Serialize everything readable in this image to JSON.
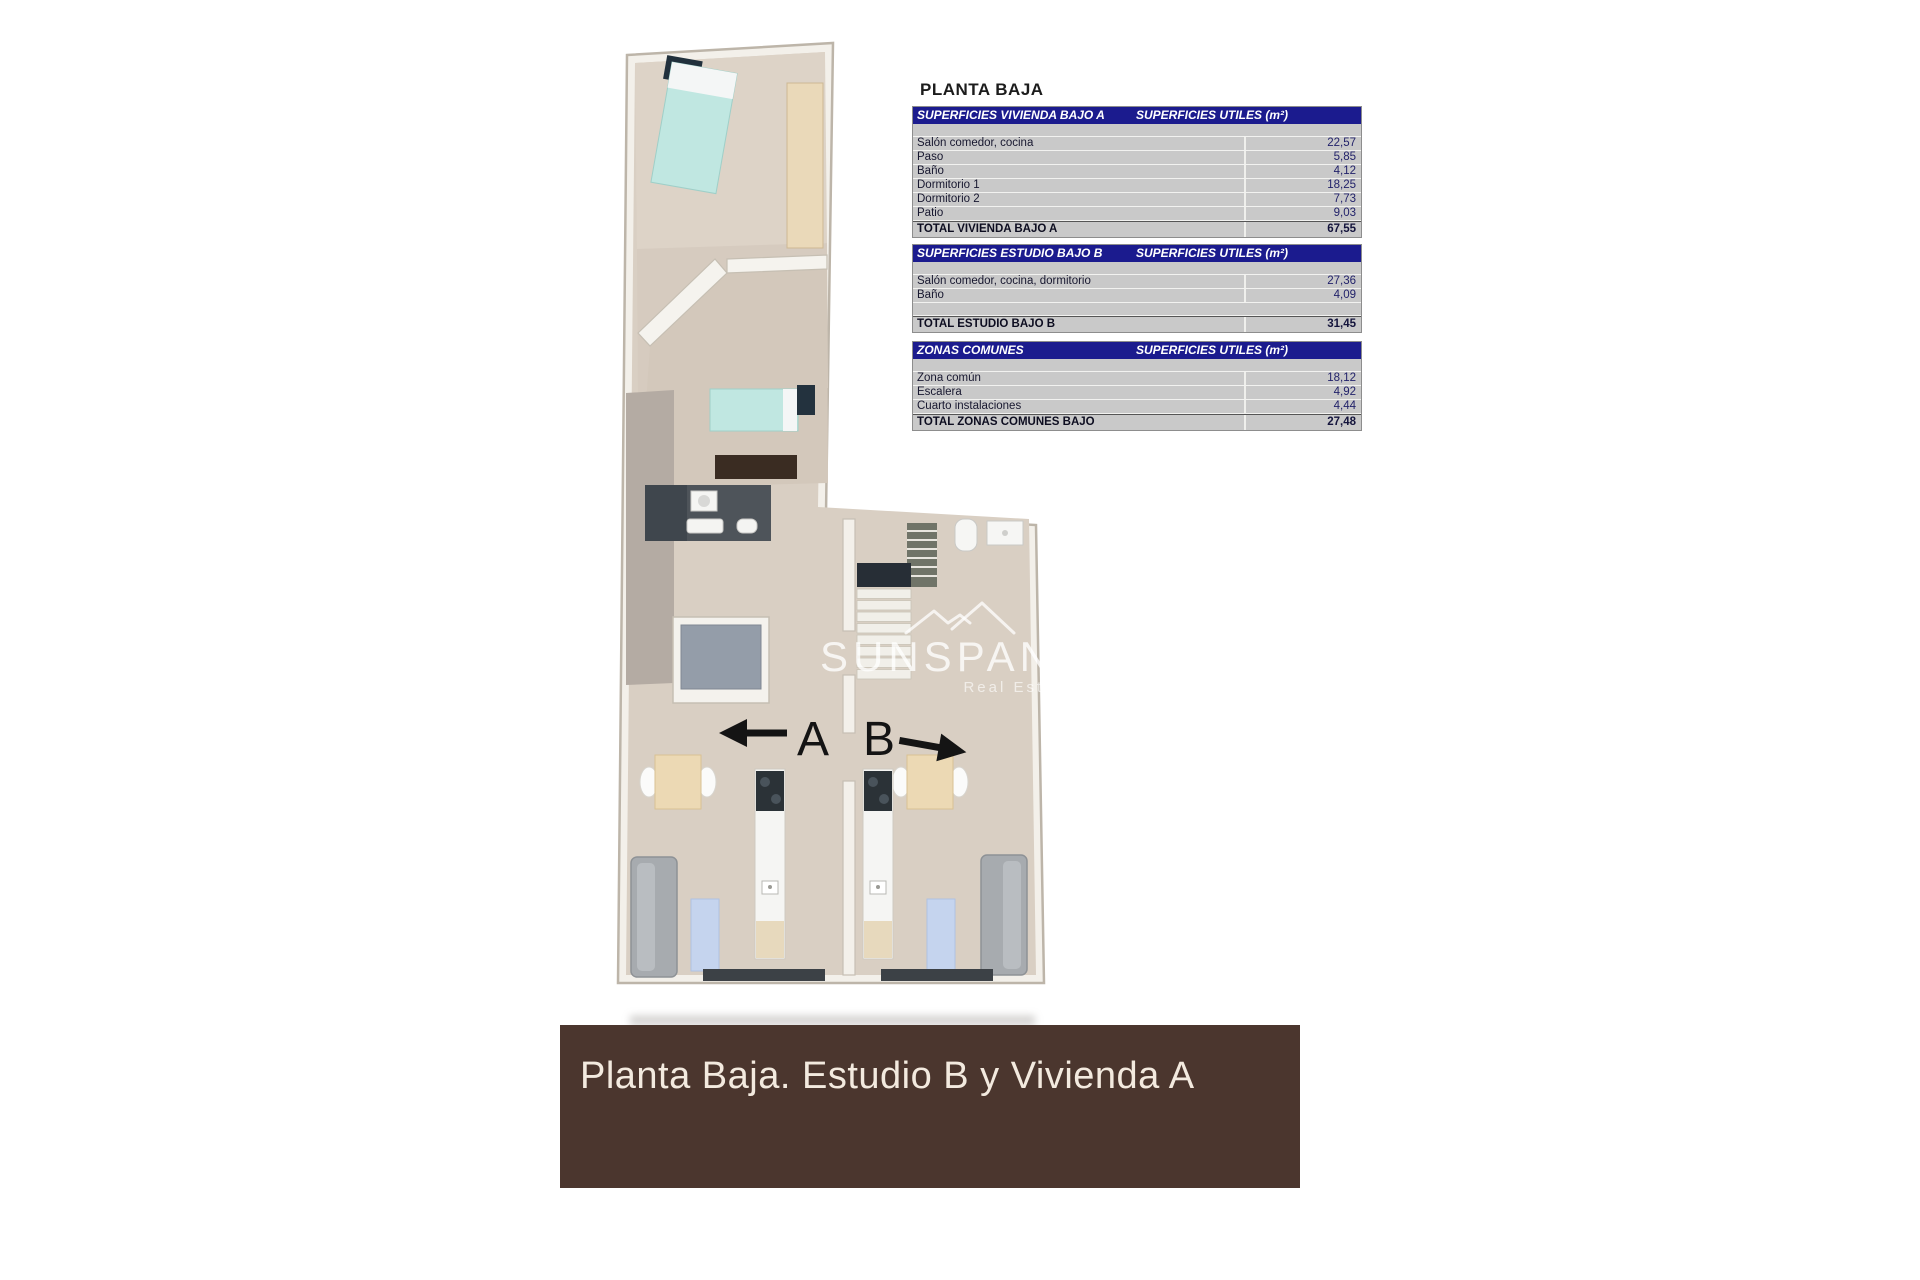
{
  "page": {
    "title_label": "PLANTA BAJA"
  },
  "tables": [
    {
      "title": "SUPERFICIES VIVIENDA BAJO A",
      "units_header": "SUPERFICIES UTILES  (m²)",
      "rows": [
        {
          "label": "Salón comedor, cocina",
          "value": "22,57"
        },
        {
          "label": "Paso",
          "value": "5,85"
        },
        {
          "label": "Baño",
          "value": "4,12"
        },
        {
          "label": "Dormitorio 1",
          "value": "18,25"
        },
        {
          "label": "Dormitorio 2",
          "value": "7,73"
        },
        {
          "label": "Patio",
          "value": "9,03"
        }
      ],
      "total": {
        "label": "TOTAL VIVIENDA BAJO A",
        "value": "67,55"
      }
    },
    {
      "title": "SUPERFICIES ESTUDIO BAJO B",
      "units_header": "SUPERFICIES UTILES  (m²)",
      "rows": [
        {
          "label": "Salón comedor, cocina, dormitorio",
          "value": "27,36"
        },
        {
          "label": "Baño",
          "value": "4,09"
        }
      ],
      "total": {
        "label": "TOTAL ESTUDIO BAJO B",
        "value": "31,45"
      }
    },
    {
      "title": "ZONAS COMUNES",
      "units_header": "SUPERFICIES UTILES  (m²)",
      "rows": [
        {
          "label": "Zona común",
          "value": "18,12"
        },
        {
          "label": "Escalera",
          "value": "4,92"
        },
        {
          "label": "Cuarto instalaciones",
          "value": "4,44"
        }
      ],
      "total": {
        "label": "TOTAL ZONAS COMUNES BAJO",
        "value": "27,48"
      }
    }
  ],
  "plan": {
    "unit_a_label": "A",
    "unit_b_label": "B",
    "watermark": {
      "brand": "SUNSPANIA",
      "tagline": "Real Estate"
    }
  },
  "banner": {
    "text": "Planta Baja. Estudio B y Vivienda A"
  },
  "colors": {
    "table_header_bg": "#1b1b8e",
    "table_body_bg": "#c9c9c9",
    "banner_bg": "#4b362e",
    "banner_text": "#f3eadf",
    "floor_beige": "#d9cfc3",
    "bed_teal": "#c0e7e1",
    "corridor_gray": "#b4aba3",
    "bath_dark": "#4e545a"
  }
}
